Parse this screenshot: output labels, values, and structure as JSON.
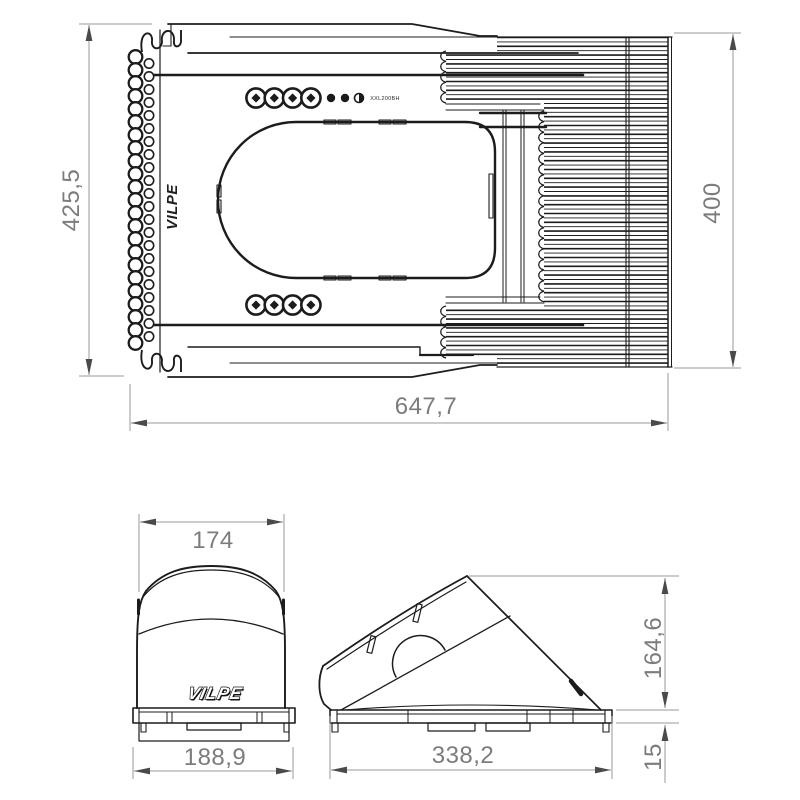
{
  "drawing": {
    "brand_logo": "VILPE",
    "views": {
      "top": {
        "name": "Top view",
        "mold_marking": "XXL200BH",
        "dims": {
          "overall_width": "425,5",
          "vent_section_height": "400",
          "overall_length": "647,7"
        }
      },
      "front": {
        "name": "Front view",
        "dims": {
          "hood_width": "174",
          "base_width": "188,9"
        }
      },
      "side": {
        "name": "Side view",
        "dims": {
          "base_length": "338,2",
          "hood_height": "164,6",
          "base_thickness": "15"
        }
      }
    },
    "colors": {
      "line": "#1c1c1c",
      "dimension": "#9a9a9a",
      "dimension_text": "#7c7c7c",
      "background": "#ffffff"
    }
  }
}
